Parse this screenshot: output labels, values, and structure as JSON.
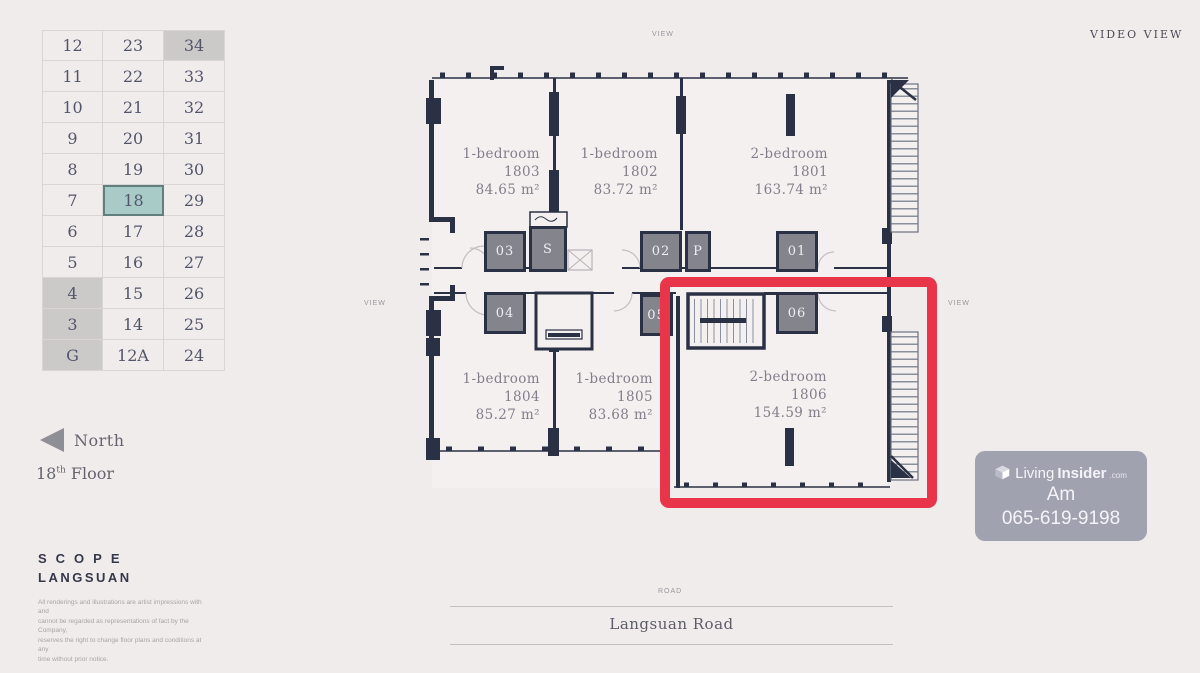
{
  "header": {
    "video_view_label": "VIDEO VIEW"
  },
  "floor_selector": {
    "rows": [
      [
        "12",
        "23",
        "34"
      ],
      [
        "11",
        "22",
        "33"
      ],
      [
        "10",
        "21",
        "32"
      ],
      [
        "9",
        "20",
        "31"
      ],
      [
        "8",
        "19",
        "30"
      ],
      [
        "7",
        "18",
        "29"
      ],
      [
        "6",
        "17",
        "28"
      ],
      [
        "5",
        "16",
        "27"
      ],
      [
        "4",
        "15",
        "26"
      ],
      [
        "3",
        "14",
        "25"
      ],
      [
        "G",
        "12A",
        "24"
      ]
    ],
    "selected_floor": "18",
    "dimmed_floors": [
      "34",
      "4",
      "3",
      "G"
    ]
  },
  "compass": {
    "north_label": "North",
    "floor_number": "18",
    "floor_suffix": "th",
    "floor_word": "Floor"
  },
  "brand": {
    "line1": "SCOPE",
    "line2": "LANGSUAN"
  },
  "disclaimer": {
    "lines": [
      "All renderings and illustrations are artist impressions with and",
      "cannot be regarded as representations of fact by the Company,",
      "reserves the right to change floor plans and conditions at any",
      "time without prior notice."
    ]
  },
  "plan_labels": {
    "top": "VIEW",
    "left": "VIEW",
    "right": "VIEW",
    "road_small": "ROAD"
  },
  "road": {
    "name": "Langsuan Road"
  },
  "units": [
    {
      "type": "1-bedroom",
      "number": "1803",
      "area": "84.65 m²",
      "highlighted": false
    },
    {
      "type": "1-bedroom",
      "number": "1802",
      "area": "83.72 m²",
      "highlighted": false
    },
    {
      "type": "2-bedroom",
      "number": "1801",
      "area": "163.74 m²",
      "highlighted": false
    },
    {
      "type": "1-bedroom",
      "number": "1804",
      "area": "85.27 m²",
      "highlighted": false
    },
    {
      "type": "1-bedroom",
      "number": "1805",
      "area": "83.68 m²",
      "highlighted": false
    },
    {
      "type": "2-bedroom",
      "number": "1806",
      "area": "154.59 m²",
      "highlighted": true
    }
  ],
  "cores": {
    "labels": [
      "03",
      "S",
      "02",
      "P",
      "01",
      "04",
      "05",
      "06"
    ]
  },
  "watermark": {
    "brand_living": "Living",
    "brand_insider": "Insider",
    "brand_tld": ".com",
    "line1": "Am",
    "line2": "065-619-9198"
  },
  "colors": {
    "accent_red": "#e8354a",
    "selected_teal": "#a8cbc7",
    "wall": "#2b3144"
  }
}
